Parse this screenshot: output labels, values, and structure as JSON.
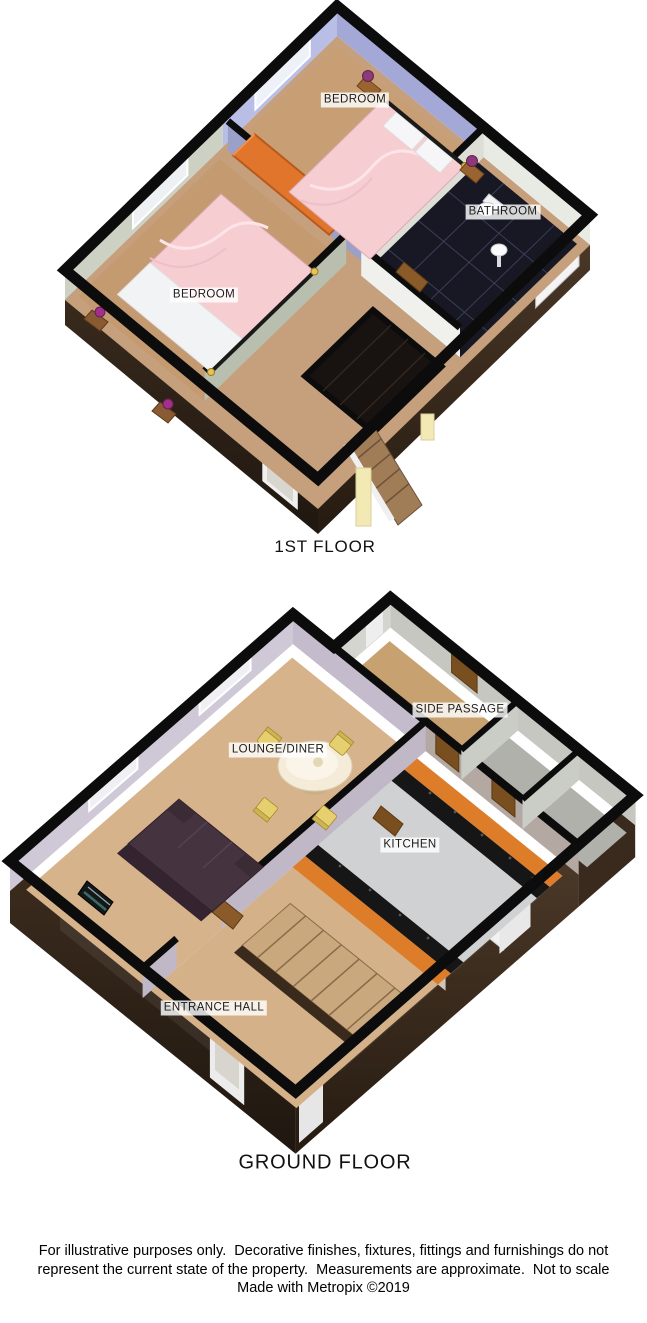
{
  "page": {
    "background": "#ffffff",
    "type": "3D property floorplan"
  },
  "floors": [
    {
      "id": "first-floor",
      "title": "1ST FLOOR",
      "rooms": [
        {
          "id": "bedroom-front",
          "label": "BEDROOM"
        },
        {
          "id": "bathroom",
          "label": "BATHROOM"
        },
        {
          "id": "bedroom-rear",
          "label": "BEDROOM"
        }
      ]
    },
    {
      "id": "ground-floor",
      "title": "GROUND FLOOR",
      "rooms": [
        {
          "id": "side-passage",
          "label": "SIDE PASSAGE"
        },
        {
          "id": "lounge-diner",
          "label": "LOUNGE/DINER"
        },
        {
          "id": "kitchen",
          "label": "KITCHEN"
        },
        {
          "id": "entrance-hall",
          "label": "ENTRANCE HALL"
        }
      ]
    }
  ],
  "footer": {
    "lines": [
      "For illustrative purposes only.  Decorative finishes, fixtures, fittings and furnishings do not",
      "represent the current state of the property.  Measurements are approximate.  Not to scale",
      "Made with Metropix ©2019"
    ]
  },
  "colors": {
    "wall_outline": "#0c0c0c",
    "exterior_wall_brown": "#33251a",
    "carpet_tan": "#c89e74",
    "bed_linen_pink": "#f6cdd1",
    "wardrobe_orange": "#e2752c",
    "bedroom_wall_lavender": "#b9bee6",
    "bathroom_floor_dark": "#171823",
    "lounge_wall_lavender": "#cfc8d6",
    "kitchen_counter_orange": "#dd7d2a",
    "kitchen_worktop_black": "#161616",
    "sofa_plum": "#463340",
    "dining_chair_yellow": "#e5cf6f",
    "door_wood": "#7a4f1f",
    "stair_post_yellow": "#f2e9b4"
  }
}
